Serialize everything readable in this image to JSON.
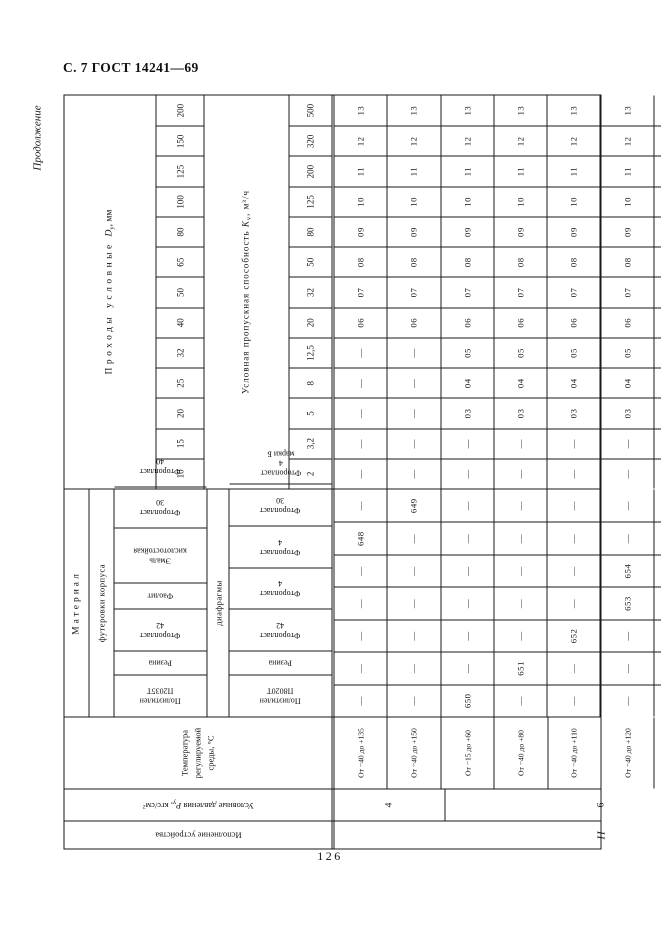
{
  "page": {
    "header_label": "С. 7 ГОСТ 14241—69",
    "continuation_label": "Продолжение",
    "page_number": "126"
  },
  "table": {
    "execution": {
      "label": "Исполнение устройства",
      "value": "II"
    },
    "pressure": {
      "label_pre": "Условные давления ",
      "symbol": "Р",
      "symbol_sub": "у",
      "label_post": ", кгс/см²",
      "cells": [
        {
          "value": "4",
          "span": 2
        },
        {
          "value": "6",
          "span": 6
        },
        {
          "value": "10",
          "span": 2
        }
      ]
    },
    "temperature": {
      "label": "Температура\nрегулируемой\nсреды, °С"
    },
    "material": {
      "group_label": "Материал",
      "lining_label": "футеровки корпуса",
      "diaphragm_label": "диафрагмы",
      "lining_names": [
        "Полиэтилен П2035Т",
        "Резина",
        "Фторопласт 42",
        "Фаолит",
        "Эмаль кислотостойкая",
        "Фторопласт 30",
        "Фторопласт 40"
      ],
      "diaphragm_names": [
        "Полиэтилен П8020Т",
        "Резина",
        "Фторопласт 42",
        "Фторопласт 4",
        "Фторопласт 4",
        "Фторопласт 30",
        "Фторопласт 4\nмарки Б"
      ]
    },
    "passage": {
      "label_spaced": "Проходы условные",
      "symbol": "D",
      "symbol_sub": "у",
      "label_post": ", мм",
      "values": [
        "10",
        "15",
        "20",
        "25",
        "32",
        "40",
        "50",
        "65",
        "80",
        "100",
        "125",
        "150",
        "200"
      ]
    },
    "capacity": {
      "label": "Условная пропускная способность",
      "symbol": "K",
      "symbol_sub": "v",
      "label_post": ", м³/ч",
      "values": [
        "2",
        "3,2",
        "5",
        "8",
        "12,5",
        "20",
        "32",
        "50",
        "80",
        "125",
        "200",
        "320",
        "500"
      ]
    },
    "rows": [
      {
        "temperature": "От −40 до +135",
        "materials": [
          "—",
          "—",
          "—",
          "—",
          "—",
          "648",
          "—"
        ],
        "capacity_codes": [
          "—",
          "—",
          "—",
          "—",
          "—",
          "06",
          "07",
          "08",
          "09",
          "10",
          "11",
          "12",
          "13"
        ]
      },
      {
        "temperature": "От −40 до +150",
        "materials": [
          "—",
          "—",
          "—",
          "—",
          "—",
          "—",
          "649"
        ],
        "capacity_codes": [
          "—",
          "—",
          "—",
          "—",
          "—",
          "06",
          "07",
          "08",
          "09",
          "10",
          "11",
          "12",
          "13"
        ]
      },
      {
        "temperature": "От −15 до +60",
        "materials": [
          "650",
          "—",
          "—",
          "—",
          "—",
          "—",
          "—"
        ],
        "capacity_codes": [
          "—",
          "—",
          "03",
          "04",
          "05",
          "06",
          "07",
          "08",
          "09",
          "10",
          "11",
          "12",
          "13"
        ]
      },
      {
        "temperature": "От −40 до +80",
        "materials": [
          "—",
          "651",
          "—",
          "—",
          "—",
          "—",
          "—"
        ],
        "capacity_codes": [
          "—",
          "—",
          "03",
          "04",
          "05",
          "06",
          "07",
          "08",
          "09",
          "10",
          "11",
          "12",
          "13"
        ]
      },
      {
        "temperature": "От −40 до +110",
        "materials": [
          "—",
          "—",
          "652",
          "—",
          "—",
          "—",
          "—"
        ],
        "capacity_codes": [
          "—",
          "—",
          "03",
          "04",
          "05",
          "06",
          "07",
          "08",
          "09",
          "10",
          "11",
          "12",
          "13"
        ]
      },
      {
        "temperature": "От −40 до +120",
        "materials": [
          "—",
          "—",
          "—",
          "653",
          "654",
          "—",
          "—"
        ],
        "capacity_codes": [
          "—",
          "—",
          "03",
          "04",
          "05",
          "06",
          "07",
          "08",
          "09",
          "10",
          "11",
          "12",
          "13"
        ]
      },
      {
        "temperature": "От −40 до +135",
        "materials": [
          "—",
          "—",
          "—",
          "—",
          "—",
          "655",
          "—"
        ],
        "capacity_codes": [
          "—",
          "—",
          "03",
          "04",
          "05",
          "06",
          "07",
          "08",
          "09",
          "10",
          "11",
          "12",
          "13"
        ]
      },
      {
        "temperature": "От −40 до +150",
        "materials": [
          "—",
          "—",
          "—",
          "—",
          "—",
          "—",
          "656"
        ],
        "capacity_codes": [
          "—",
          "—",
          "03",
          "04",
          "05",
          "06",
          "07",
          "08",
          "09",
          "10",
          "11",
          "12",
          "13"
        ]
      },
      {
        "temperature": "От −15 до +60",
        "materials": [
          "657",
          "—",
          "—",
          "—",
          "—",
          "—",
          "—"
        ],
        "capacity_codes": [
          "01",
          "02",
          "03",
          "04",
          "05",
          "06",
          "07",
          "08",
          "09",
          "10",
          "—",
          "—",
          "—"
        ]
      },
      {
        "temperature": "От −40 до +80",
        "materials": [
          "—",
          "658",
          "—",
          "—",
          "—",
          "—",
          "—"
        ],
        "capacity_codes": [
          "01",
          "02",
          "03",
          "04",
          "05",
          "06",
          "07",
          "08",
          "09",
          "10",
          "—",
          "—",
          "—"
        ]
      }
    ]
  }
}
